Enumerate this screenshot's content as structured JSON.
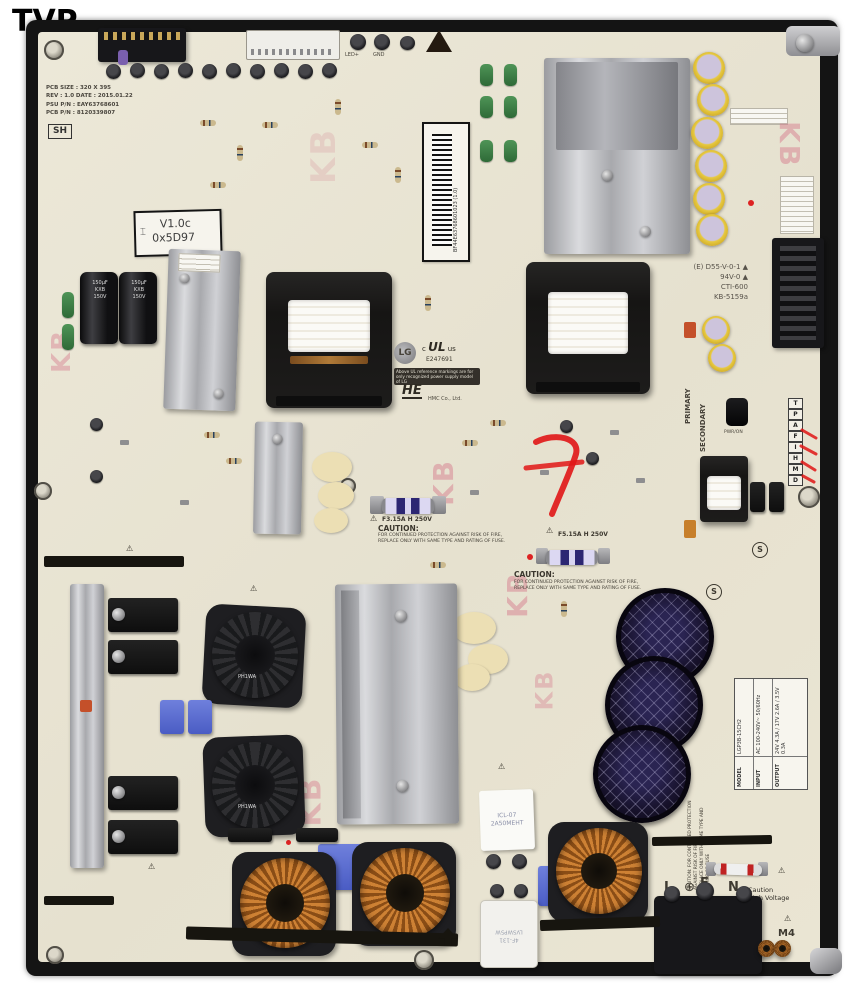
{
  "page": {
    "watermark": "TVP"
  },
  "colors": {
    "board": "#e9e4d3",
    "frame": "#141414",
    "copper": "#c07c30",
    "stamp_pink": "#d77f90",
    "marker_red": "#e01616",
    "cap_yellow": "#e7c93f",
    "film_blue": "#5566cc"
  },
  "board": {
    "info": {
      "l1": "PCB SIZE : 320 X 395",
      "l2": "REV : 1.0  DATE : 2015.01.22",
      "l3": "PSU P/N : EAY63768601",
      "l4": "PCB P/N : 8120339807",
      "stamp": "SH"
    },
    "version": {
      "l1": "V1.0c",
      "l2": "0x5D97"
    },
    "barcode": {
      "text": "BF44E63768601023 (1.0)"
    },
    "ul": {
      "lg": "LG",
      "c": "c",
      "mark": "UL",
      "us": "us",
      "number": "E247691",
      "note": "Above UL reference markings are for only recognized power supply model of LG",
      "logo": "HE",
      "maker": "HMC Co., Ltd."
    },
    "ratings": {
      "l1": "(E) D55-V-0-1 ▲",
      "l2": "94V-0 ▲",
      "l3": "CTI-600",
      "l4": "KB-5159a"
    },
    "labels": {
      "led": "LED+",
      "gnd": "GND",
      "pwr": "PWR/ON",
      "primary": "PRIMARY",
      "secondary": "SECONDARY",
      "m4": "M4",
      "s": "S",
      "kb": "KB"
    },
    "terminals": {
      "l": "L",
      "earth": "⊕",
      "e": "E",
      "n": "N"
    },
    "hv": {
      "l1": "Caution",
      "l2": "High Voltage"
    },
    "caution1": {
      "fuse": "F3.15A H 250V",
      "title": "CAUTION:",
      "b1": "FOR CONTINUED PROTECTION AGAINST RISK OF FIRE,",
      "b2": "REPLACE ONLY WITH SAME TYPE AND RATING OF FUSE."
    },
    "caution2": {
      "fuse": "F5.15A H 250V",
      "title": "CAUTION:",
      "b1": "FOR CONTINUED PROTECTION AGAINST RISK OF FIRE,",
      "b2": "REPLACE ONLY WITH SAME TYPE AND RATING OF FUSE."
    },
    "side_caution": {
      "l1": "CAUTION: FOR CONTINUED PROTECTION AGAINST RISK OF FIRE,",
      "l2": "REPLACE ONLY WITH SAME TYPE AND RATING OF FUSE"
    },
    "pins": [
      "T",
      "P",
      "A",
      "F",
      "I",
      "H",
      "M",
      "D"
    ],
    "spec": {
      "r1": [
        "MODEL",
        "LGP3B-15CH2"
      ],
      "r2": [
        "INPUT",
        "AC 100-240V~  50/60Hz"
      ],
      "r3": [
        "OUTPUT",
        "24V 4.3A / 17V 2.6A / 3.5V 0.3A"
      ]
    },
    "caps": {
      "brand": "KXB",
      "volt": "150V",
      "uf": "150µF"
    },
    "choke_label": "PH1WA",
    "icl": {
      "l1": "ICL-07",
      "l2": "2A50MEHT"
    },
    "relay": {
      "l1": "LVSWP5W",
      "l2": "4F-131"
    }
  }
}
